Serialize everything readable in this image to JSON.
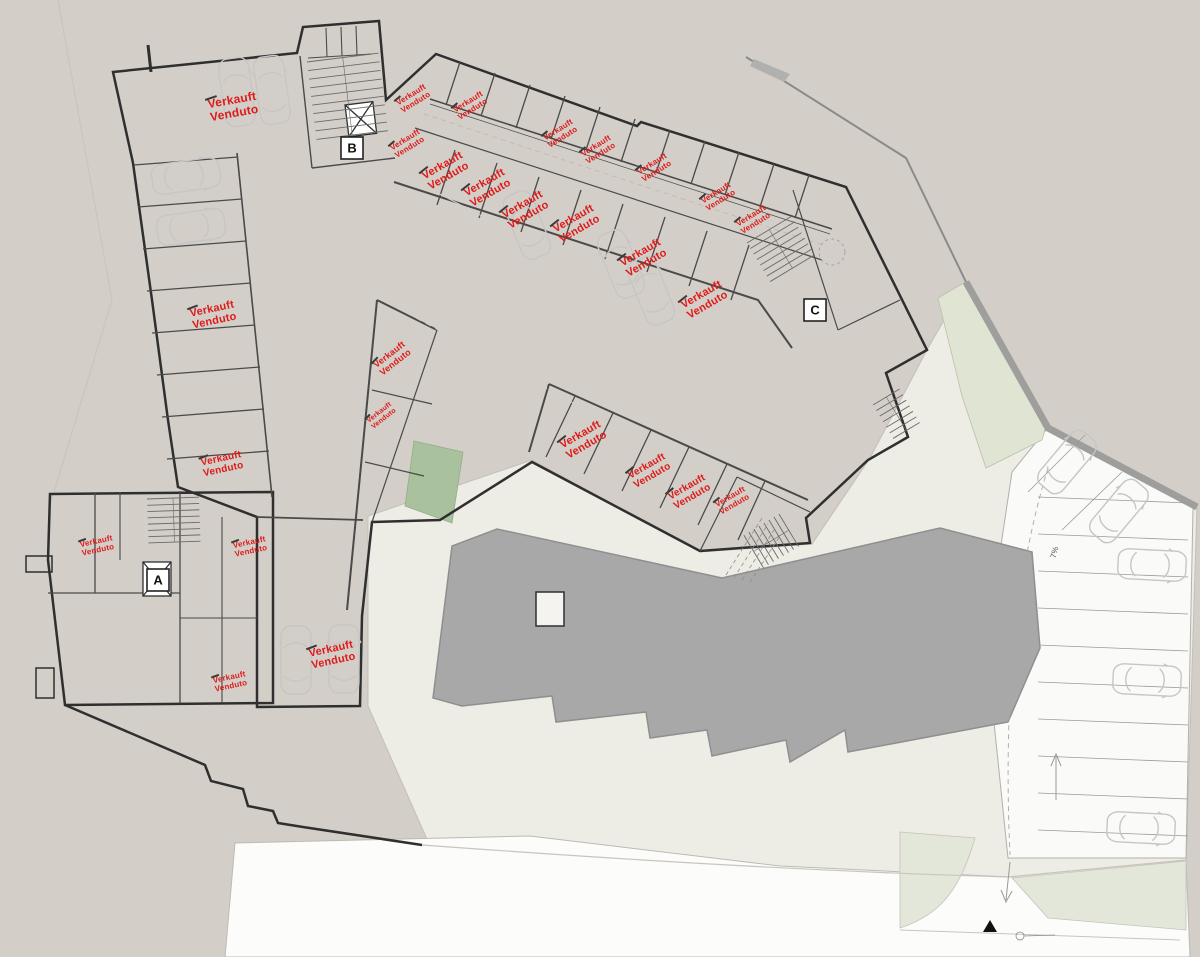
{
  "plan": {
    "sold_label": {
      "line1": "Verkauft",
      "line2": "Venduto"
    },
    "stairwells": [
      {
        "letter": "A",
        "x": 158,
        "y": 580
      },
      {
        "letter": "B",
        "x": 352,
        "y": 148
      },
      {
        "letter": "C",
        "x": 815,
        "y": 310
      }
    ],
    "slope_label": {
      "text": "7%",
      "x": 1057,
      "y": 553,
      "rot": -75
    },
    "sold_instances": [
      {
        "x": 233,
        "y": 106,
        "rot": -10,
        "s": 12
      },
      {
        "x": 213,
        "y": 314,
        "rot": -12,
        "s": 11
      },
      {
        "x": 222,
        "y": 463,
        "rot": -12,
        "s": 10
      },
      {
        "x": 413,
        "y": 98,
        "rot": -32,
        "s": 8
      },
      {
        "x": 470,
        "y": 105,
        "rot": -32,
        "s": 8
      },
      {
        "x": 407,
        "y": 143,
        "rot": -32,
        "s": 8
      },
      {
        "x": 560,
        "y": 133,
        "rot": -32,
        "s": 8
      },
      {
        "x": 598,
        "y": 149,
        "rot": -32,
        "s": 8
      },
      {
        "x": 654,
        "y": 167,
        "rot": -32,
        "s": 8
      },
      {
        "x": 718,
        "y": 196,
        "rot": -32,
        "s": 8
      },
      {
        "x": 753,
        "y": 219,
        "rot": -32,
        "s": 8
      },
      {
        "x": 445,
        "y": 170,
        "rot": -30,
        "s": 11
      },
      {
        "x": 487,
        "y": 187,
        "rot": -30,
        "s": 11
      },
      {
        "x": 525,
        "y": 209,
        "rot": -30,
        "s": 11
      },
      {
        "x": 576,
        "y": 223,
        "rot": -30,
        "s": 11
      },
      {
        "x": 643,
        "y": 257,
        "rot": -30,
        "s": 11
      },
      {
        "x": 704,
        "y": 299,
        "rot": -30,
        "s": 11
      },
      {
        "x": 392,
        "y": 358,
        "rot": -38,
        "s": 9
      },
      {
        "x": 381,
        "y": 415,
        "rot": -38,
        "s": 7
      },
      {
        "x": 583,
        "y": 439,
        "rot": -30,
        "s": 11
      },
      {
        "x": 649,
        "y": 470,
        "rot": -30,
        "s": 10
      },
      {
        "x": 689,
        "y": 491,
        "rot": -30,
        "s": 10
      },
      {
        "x": 732,
        "y": 500,
        "rot": -30,
        "s": 8
      },
      {
        "x": 97,
        "y": 545,
        "rot": -12,
        "s": 8
      },
      {
        "x": 250,
        "y": 546,
        "rot": -12,
        "s": 8
      },
      {
        "x": 230,
        "y": 681,
        "rot": -12,
        "s": 8
      },
      {
        "x": 332,
        "y": 654,
        "rot": -12,
        "s": 11
      }
    ]
  },
  "colors": {
    "terrain": "#d3cfc8",
    "pale": "#edece5",
    "road": "#fcfcfa",
    "parking": "#fafaf8",
    "green_bright": "#a9c29d",
    "green_pale": "#dfe5d2",
    "green_soft": "#e3e7d9",
    "footprint": "#a8a8a8",
    "footprint_edge": "#8f8f8f",
    "wall_gray": "#9e9e9c",
    "path_gray": "#b0b0ae",
    "white": "#ffffff",
    "red": "#df1a1a",
    "car": "#c6c6c6"
  }
}
